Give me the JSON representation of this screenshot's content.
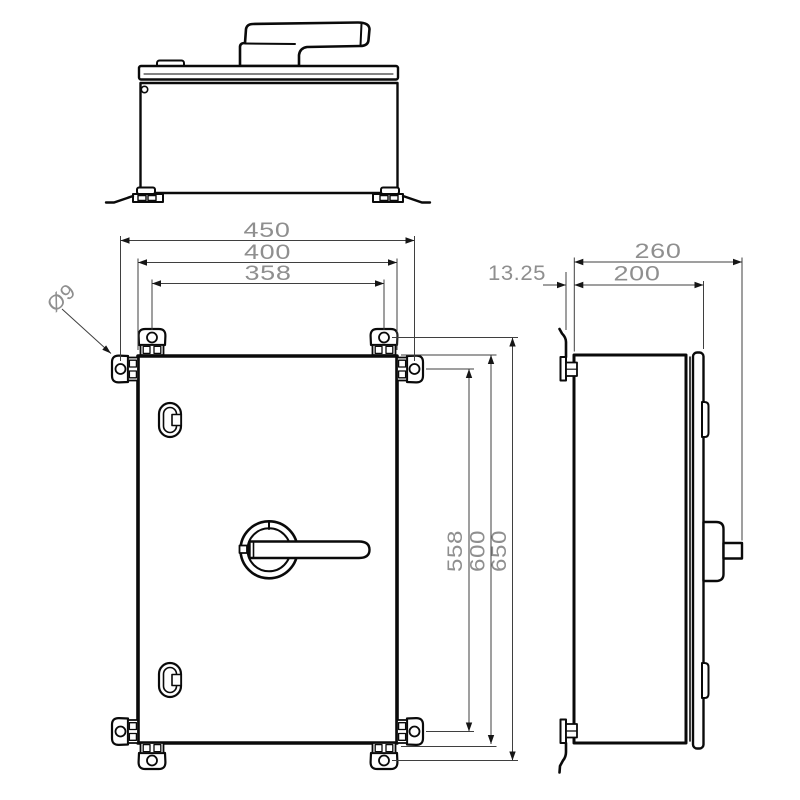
{
  "drawing": {
    "type": "technical_drawing_three_views",
    "line_color": "#0a0a0a",
    "dimension_text_color": "#8f8f8f",
    "dimensions": {
      "overall_width": "450",
      "enclosure_width": "400",
      "mounting_hole_spacing_horizontal": "358",
      "mounting_hole_diameter": "Ø9",
      "mounting_hole_spacing_vertical": "558",
      "enclosure_height": "600",
      "overall_height": "650",
      "bracket_offset": "13.25",
      "overall_depth": "260",
      "enclosure_depth": "200"
    }
  }
}
